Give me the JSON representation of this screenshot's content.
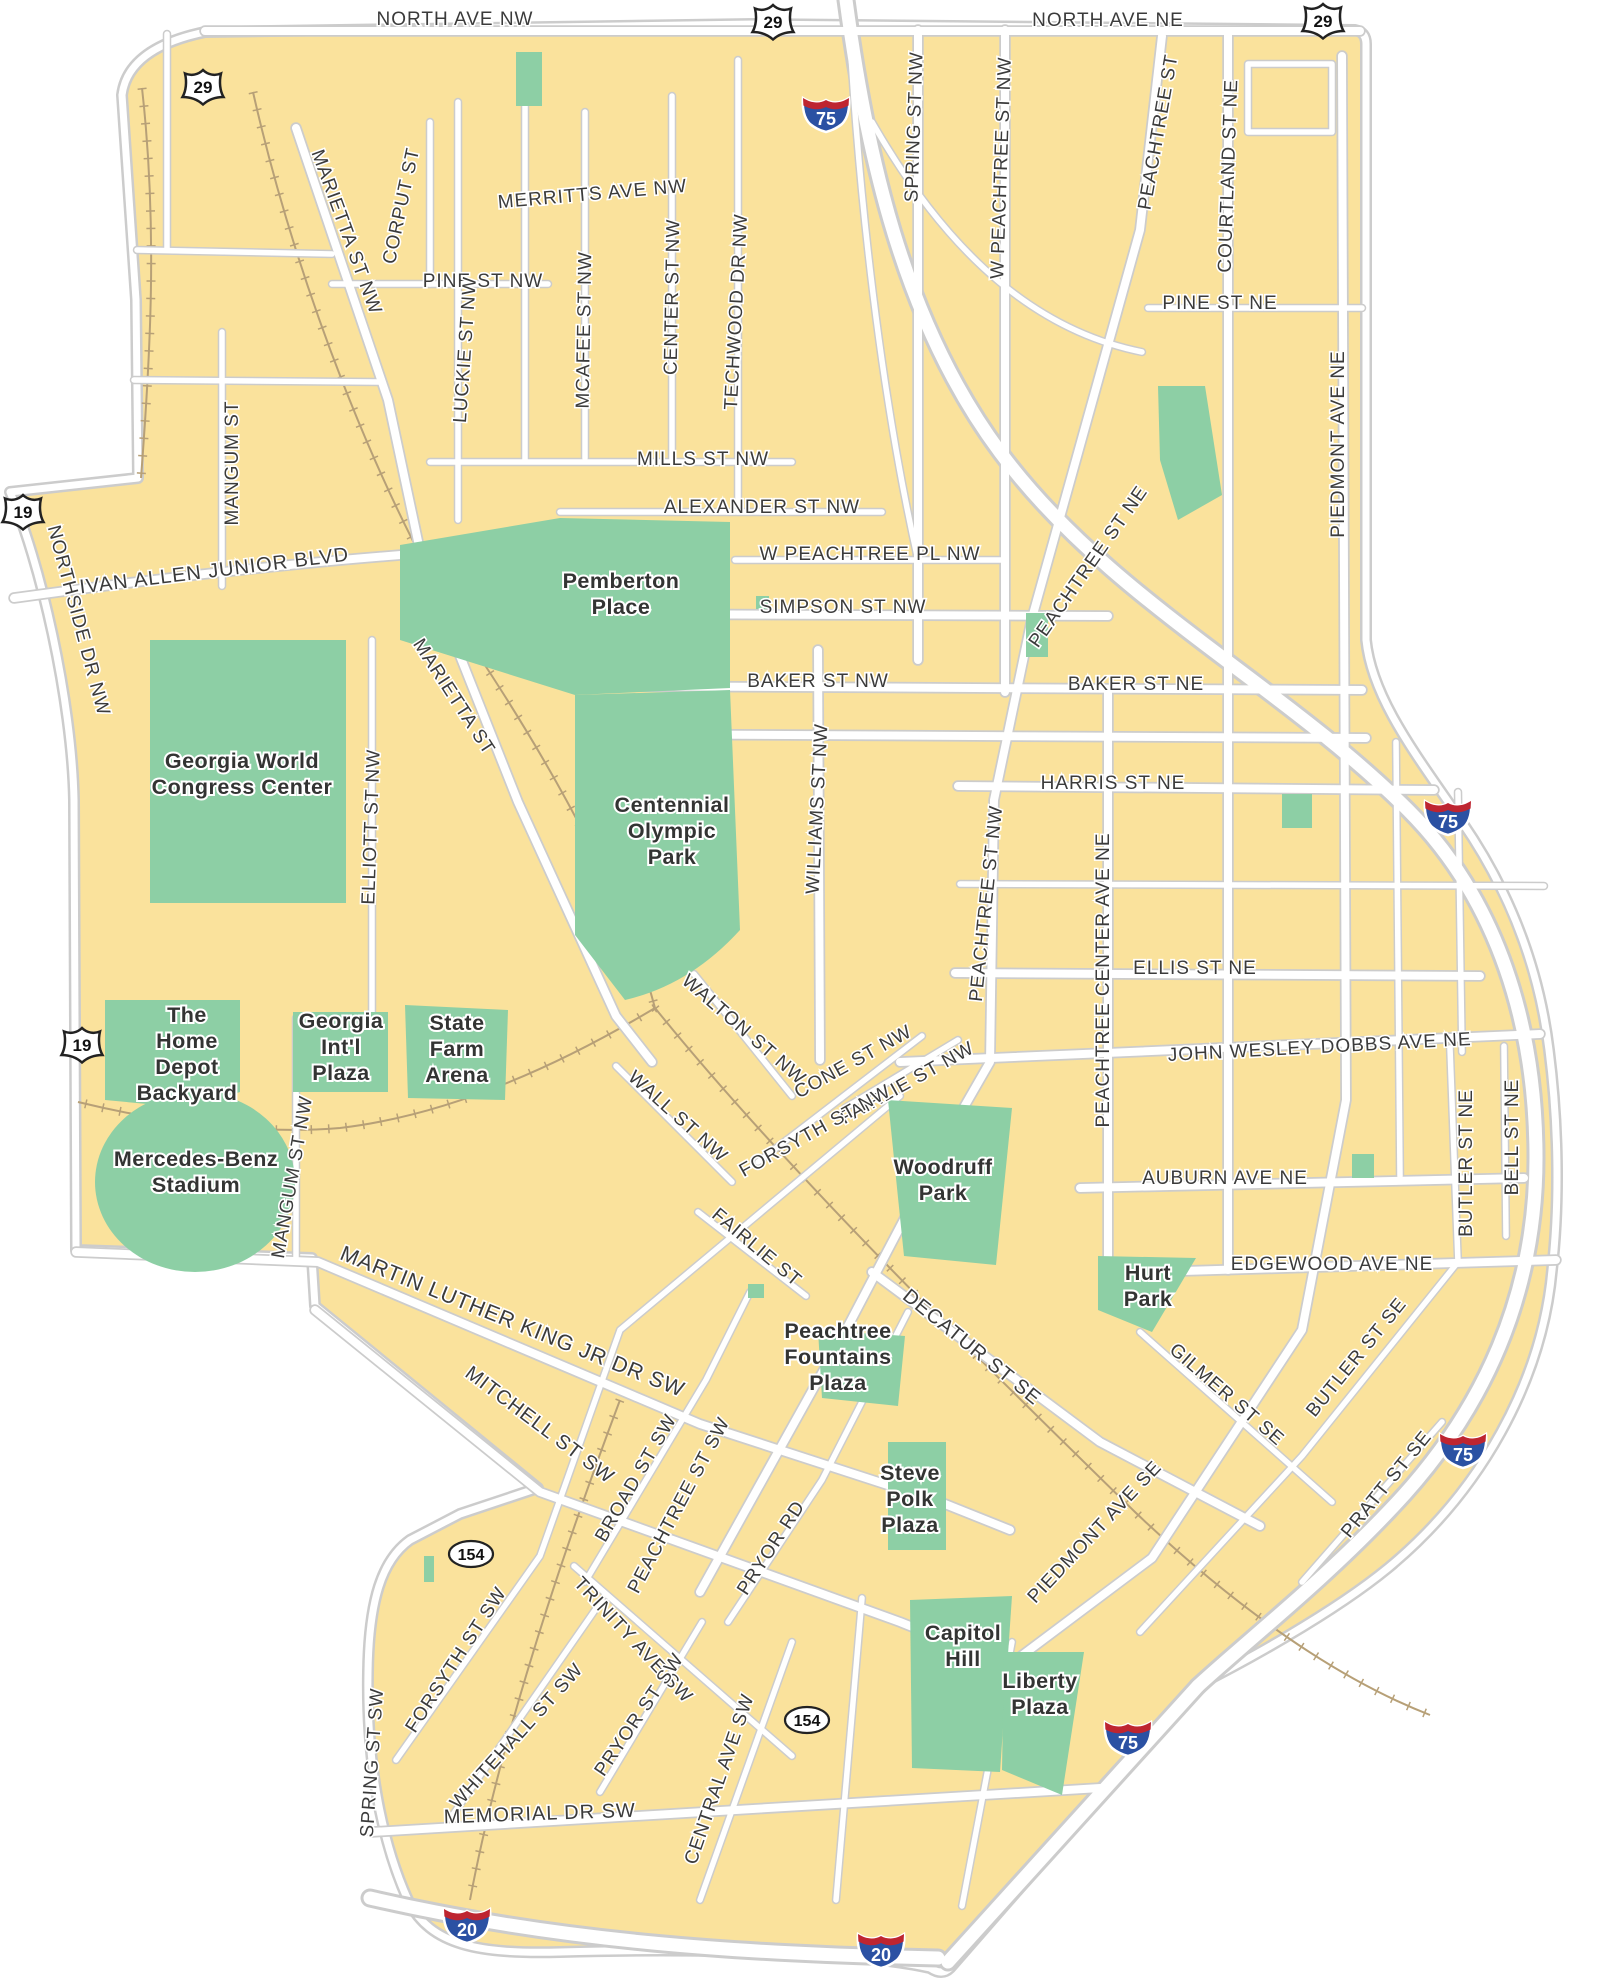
{
  "map": {
    "colors": {
      "background": "#FFFFFF",
      "land": "#FAE29C",
      "park": "#8DCFA5",
      "road_fill": "#FFFFFF",
      "road_casing": "#CCCCCC",
      "rail": "#B7A077",
      "label_text": "#3B3B3B",
      "interstate_blue": "#2B51A3",
      "interstate_red": "#BE2530",
      "shield_white": "#FFFFFF",
      "shield_outline": "#222222"
    },
    "street_labels": [
      {
        "t": "NORTH AVE NW",
        "x": 455,
        "y": 25,
        "r": 0
      },
      {
        "t": "NORTH AVE NE",
        "x": 1108,
        "y": 26,
        "r": 0
      },
      {
        "t": "MERRITTS AVE NW",
        "x": 593,
        "y": 200,
        "r": -5
      },
      {
        "t": "PINE ST NW",
        "x": 483,
        "y": 287,
        "r": 0
      },
      {
        "t": "PINE ST NE",
        "x": 1220,
        "y": 309,
        "r": 0
      },
      {
        "t": "MILLS ST NW",
        "x": 703,
        "y": 465,
        "r": 0
      },
      {
        "t": "ALEXANDER ST NW",
        "x": 762,
        "y": 513,
        "r": 0
      },
      {
        "t": "W PEACHTREE PL NW",
        "x": 870,
        "y": 560,
        "r": 0
      },
      {
        "t": "SIMPSON ST NW",
        "x": 843,
        "y": 613,
        "r": 0
      },
      {
        "t": "BAKER ST NW",
        "x": 818,
        "y": 687,
        "r": 0
      },
      {
        "t": "BAKER ST NE",
        "x": 1136,
        "y": 690,
        "r": 0
      },
      {
        "t": "HARRIS ST NE",
        "x": 1113,
        "y": 789,
        "r": 0
      },
      {
        "t": "ELLIS ST NE",
        "x": 1195,
        "y": 974,
        "r": 0
      },
      {
        "t": "JOHN WESLEY DOBBS AVE NE",
        "x": 1320,
        "y": 1053,
        "r": -3
      },
      {
        "t": "AUBURN AVE NE",
        "x": 1225,
        "y": 1184,
        "r": 0
      },
      {
        "t": "EDGEWOOD AVE NE",
        "x": 1332,
        "y": 1270,
        "r": 0
      },
      {
        "t": "IVAN ALLEN JUNIOR BLVD",
        "x": 215,
        "y": 577,
        "r": -7,
        "s": 20
      },
      {
        "t": "MEMORIAL DR SW",
        "x": 540,
        "y": 1820,
        "r": -2,
        "s": 20
      },
      {
        "t": "MARIETTA ST NW",
        "x": 341,
        "y": 234,
        "r": 70
      },
      {
        "t": "CORPUT ST",
        "x": 407,
        "y": 207,
        "r": -78
      },
      {
        "t": "MARIETTA ST",
        "x": 449,
        "y": 700,
        "r": 57
      },
      {
        "t": "MANGUM ST",
        "x": 238,
        "y": 463,
        "r": -90
      },
      {
        "t": "MANGUM ST NW",
        "x": 298,
        "y": 1178,
        "r": -80
      },
      {
        "t": "NORTHSIDE DR NW",
        "x": 73,
        "y": 622,
        "r": 75
      },
      {
        "t": "LUCKIE ST NW",
        "x": 471,
        "y": 350,
        "r": -86
      },
      {
        "t": "MCAFEE ST NW",
        "x": 590,
        "y": 330,
        "r": -89
      },
      {
        "t": "CENTER ST NW",
        "x": 678,
        "y": 297,
        "r": -89
      },
      {
        "t": "TECHWOOD DR NW",
        "x": 742,
        "y": 312,
        "r": -87
      },
      {
        "t": "SPRING ST NW",
        "x": 920,
        "y": 127,
        "r": -88
      },
      {
        "t": "W PEACHTREE ST NW",
        "x": 1007,
        "y": 168,
        "r": -88
      },
      {
        "t": "PEACHTREE ST",
        "x": 1164,
        "y": 133,
        "r": -80
      },
      {
        "t": "COURTLAND ST NE",
        "x": 1234,
        "y": 176,
        "r": -88
      },
      {
        "t": "PIEDMONT AVE NE",
        "x": 1344,
        "y": 444,
        "r": -90
      },
      {
        "t": "PEACHTREE ST NE",
        "x": 1093,
        "y": 570,
        "r": -55
      },
      {
        "t": "ELLIOTT ST NW",
        "x": 377,
        "y": 827,
        "r": -88
      },
      {
        "t": "WILLIAMS ST NW",
        "x": 823,
        "y": 809,
        "r": -87
      },
      {
        "t": "PEACHTREE ST NW",
        "x": 992,
        "y": 904,
        "r": -84
      },
      {
        "t": "PEACHTREE CENTER AVE NE",
        "x": 1109,
        "y": 980,
        "r": -90
      },
      {
        "t": "BUTLER ST NE",
        "x": 1472,
        "y": 1163,
        "r": -90
      },
      {
        "t": "BELL ST NE",
        "x": 1518,
        "y": 1137,
        "r": -90
      },
      {
        "t": "WALTON ST NW",
        "x": 740,
        "y": 1034,
        "r": 41
      },
      {
        "t": "CONE ST NW",
        "x": 856,
        "y": 1067,
        "r": -29
      },
      {
        "t": "FAIRLIE ST NW",
        "x": 910,
        "y": 1088,
        "r": -29
      },
      {
        "t": "FORSYTH ST NW",
        "x": 818,
        "y": 1136,
        "r": -29
      },
      {
        "t": "WALL ST NW",
        "x": 674,
        "y": 1121,
        "r": 42
      },
      {
        "t": "FAIRLIE ST",
        "x": 753,
        "y": 1252,
        "r": 40
      },
      {
        "t": "MARTIN LUTHER KING JR DR SW",
        "x": 510,
        "y": 1328,
        "r": 22,
        "s": 21.5
      },
      {
        "t": "MITCHELL ST SW",
        "x": 536,
        "y": 1430,
        "r": 37,
        "s": 20
      },
      {
        "t": "DECATUR ST SE",
        "x": 968,
        "y": 1352,
        "r": 39,
        "s": 20
      },
      {
        "t": "GILMER ST SE",
        "x": 1223,
        "y": 1399,
        "r": 41
      },
      {
        "t": "BUTLER ST SE",
        "x": 1361,
        "y": 1361,
        "r": -51
      },
      {
        "t": "PRATT ST SE",
        "x": 1391,
        "y": 1488,
        "r": -51
      },
      {
        "t": "PIEDMONT AVE SE",
        "x": 1099,
        "y": 1536,
        "r": -47
      },
      {
        "t": "BROAD ST SW",
        "x": 641,
        "y": 1481,
        "r": -60
      },
      {
        "t": "PEACHTREE ST SW",
        "x": 684,
        "y": 1508,
        "r": -62
      },
      {
        "t": "PRYOR RD",
        "x": 776,
        "y": 1551,
        "r": -57
      },
      {
        "t": "FORSYTH ST SW",
        "x": 461,
        "y": 1663,
        "r": -57
      },
      {
        "t": "WHITEHALL ST SW",
        "x": 521,
        "y": 1740,
        "r": -48
      },
      {
        "t": "TRINITY AVE SW",
        "x": 629,
        "y": 1644,
        "r": 47
      },
      {
        "t": "PRYOR ST SW",
        "x": 644,
        "y": 1718,
        "r": -56
      },
      {
        "t": "CENTRAL AVE SW",
        "x": 725,
        "y": 1781,
        "r": -71
      },
      {
        "t": "SPRING ST SW",
        "x": 378,
        "y": 1763,
        "r": -86
      }
    ],
    "park_labels": [
      {
        "lines": [
          "Pemberton",
          "Place"
        ],
        "x": 621,
        "y": 588
      },
      {
        "lines": [
          "Georgia World",
          "Congress Center"
        ],
        "x": 242,
        "y": 768
      },
      {
        "lines": [
          "Centennial",
          "Olympic",
          "Park"
        ],
        "x": 672,
        "y": 812
      },
      {
        "lines": [
          "The",
          "Home",
          "Depot",
          "Backyard"
        ],
        "x": 187,
        "y": 1022
      },
      {
        "lines": [
          "Georgia",
          "Int'l",
          "Plaza"
        ],
        "x": 341,
        "y": 1028
      },
      {
        "lines": [
          "State",
          "Farm",
          "Arena"
        ],
        "x": 457,
        "y": 1030
      },
      {
        "lines": [
          "Mercedes-Benz",
          "Stadium"
        ],
        "x": 196,
        "y": 1166
      },
      {
        "lines": [
          "Woodruff",
          "Park"
        ],
        "x": 943,
        "y": 1174
      },
      {
        "lines": [
          "Hurt",
          "Park"
        ],
        "x": 1148,
        "y": 1280
      },
      {
        "lines": [
          "Peachtree",
          "Fountains",
          "Plaza"
        ],
        "x": 838,
        "y": 1338
      },
      {
        "lines": [
          "Steve",
          "Polk",
          "Plaza"
        ],
        "x": 910,
        "y": 1480
      },
      {
        "lines": [
          "Capitol",
          "Hill"
        ],
        "x": 963,
        "y": 1640
      },
      {
        "lines": [
          "Liberty",
          "Plaza"
        ],
        "x": 1040,
        "y": 1688
      }
    ],
    "shields": [
      {
        "type": "us",
        "label": "29",
        "x": 203,
        "y": 86
      },
      {
        "type": "us",
        "label": "29",
        "x": 773,
        "y": 21
      },
      {
        "type": "us",
        "label": "29",
        "x": 1323,
        "y": 20
      },
      {
        "type": "us",
        "label": "19",
        "x": 23,
        "y": 511
      },
      {
        "type": "us",
        "label": "19",
        "x": 82,
        "y": 1044
      },
      {
        "type": "interstate",
        "label": "75",
        "x": 826,
        "y": 112
      },
      {
        "type": "interstate",
        "label": "75",
        "x": 1448,
        "y": 815
      },
      {
        "type": "interstate",
        "label": "75",
        "x": 1463,
        "y": 1448
      },
      {
        "type": "interstate",
        "label": "75",
        "x": 1128,
        "y": 1736
      },
      {
        "type": "interstate",
        "label": "20",
        "x": 467,
        "y": 1923
      },
      {
        "type": "interstate",
        "label": "20",
        "x": 881,
        "y": 1948
      },
      {
        "type": "state",
        "label": "154",
        "x": 471,
        "y": 1554
      },
      {
        "type": "state",
        "label": "154",
        "x": 807,
        "y": 1720
      }
    ]
  }
}
